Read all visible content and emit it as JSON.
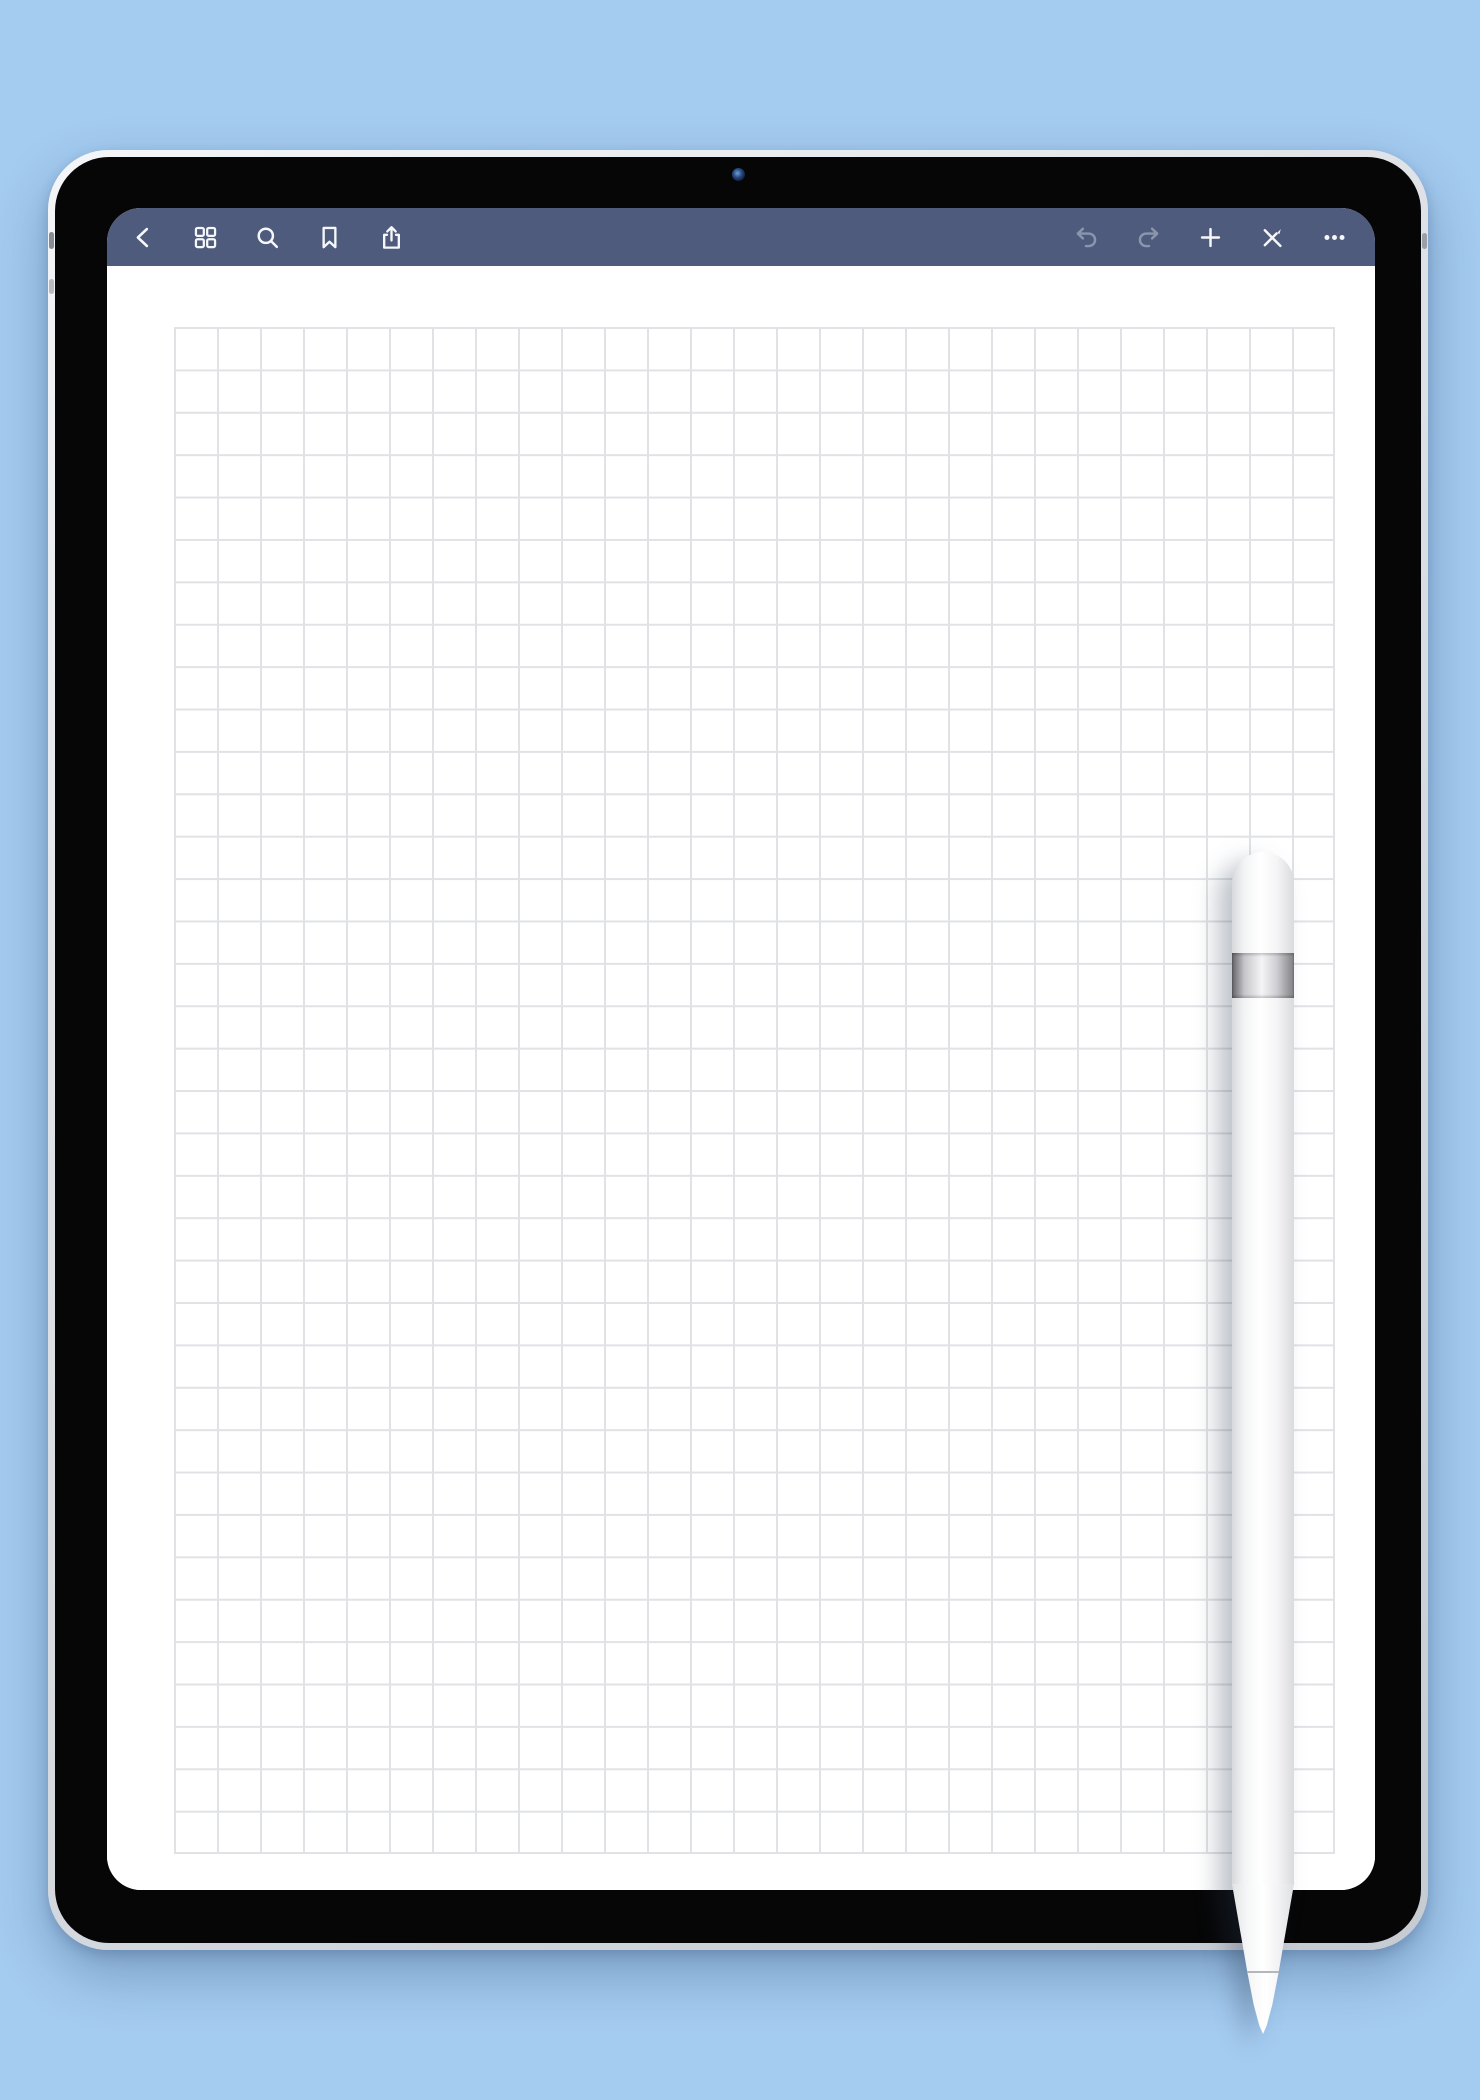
{
  "app": {
    "name": "note-taking-app",
    "page_type": "square-grid-graph-paper",
    "visible_text": ""
  },
  "colors": {
    "background": "#a4cbf0",
    "toolbar": "#4e5b7d",
    "icon_active": "#f5f7fa",
    "icon_disabled": "#8b95ad",
    "paper": "#ffffff",
    "grid_line": "#e1e2e6",
    "bezel": "#060607",
    "frame": "#d6dade"
  },
  "toolbar": {
    "left": [
      {
        "name": "chevron-left-icon",
        "label": "Back",
        "enabled": true
      },
      {
        "name": "thumbnails-grid-icon",
        "label": "Thumbnails",
        "enabled": true
      },
      {
        "name": "search-icon",
        "label": "Search",
        "enabled": true
      },
      {
        "name": "bookmark-icon",
        "label": "Bookmark",
        "enabled": true
      },
      {
        "name": "share-icon",
        "label": "Share",
        "enabled": true
      }
    ],
    "right": [
      {
        "name": "undo-icon",
        "label": "Undo",
        "enabled": false
      },
      {
        "name": "redo-icon",
        "label": "Redo",
        "enabled": false
      },
      {
        "name": "plus-icon",
        "label": "Add Page",
        "enabled": true
      },
      {
        "name": "pen-crossed-icon",
        "label": "Pen Mode",
        "enabled": true
      },
      {
        "name": "ellipsis-icon",
        "label": "More",
        "enabled": true
      }
    ]
  },
  "canvas": {
    "pattern": "square-grid",
    "cell_size_px": 43,
    "columns": 27,
    "rows": 36,
    "content": "empty page"
  },
  "hardware": {
    "device": "tablet",
    "camera": "front-camera",
    "stylus": "white stylus pen with silver band resting on screen"
  }
}
